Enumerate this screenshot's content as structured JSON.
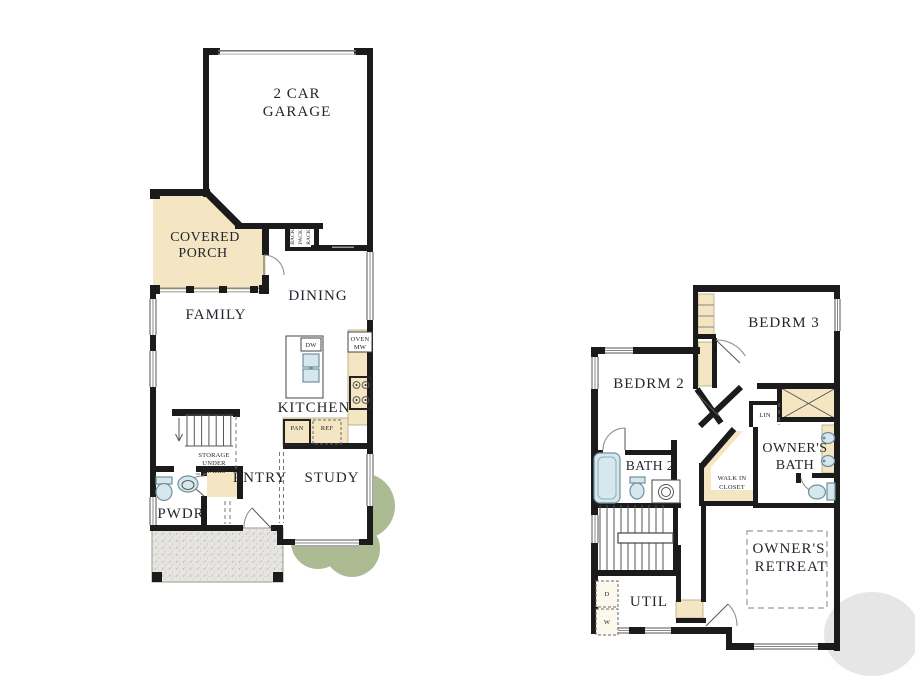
{
  "first_floor": {
    "garage": {
      "line1": "2 CAR",
      "line2": "GARAGE"
    },
    "covered_porch": {
      "line1": "COVERED",
      "line2": "PORCH"
    },
    "family": "FAMILY",
    "dining": "DINING",
    "kitchen": "KITCHEN",
    "entry": "ENTRY",
    "study": "STUDY",
    "pwdr": "PWDR",
    "storage": {
      "line1": "STORAGE",
      "line2": "UNDER",
      "line3": "STAIRS"
    },
    "back_rack": {
      "word1": "BACK",
      "word2": "PACK",
      "word3": "RACK"
    },
    "appliances": {
      "dw": "DW",
      "oven": "OVEN",
      "mw": "MW",
      "pan": "PAN",
      "ref": "REF"
    }
  },
  "second_floor": {
    "bedrm2": "BEDRM 2",
    "bedrm3": "BEDRM 3",
    "bath2": "BATH 2",
    "owners_bath": {
      "line1": "OWNER'S",
      "line2": "BATH"
    },
    "owners_retreat": {
      "line1": "OWNER'S",
      "line2": "RETREAT"
    },
    "walk_in_closet": {
      "line1": "WALK IN",
      "line2": "CLOSET"
    },
    "util": "UTIL",
    "lin": "LIN",
    "dryer": "D",
    "washer": "W"
  },
  "colors": {
    "wall": "#1b1b1b",
    "tan": "#f5e6c3",
    "porch_gray": "#e6e5e1",
    "tree_green": "#adbb92",
    "fixture": "#d6e8ee",
    "text": "#23262e"
  }
}
